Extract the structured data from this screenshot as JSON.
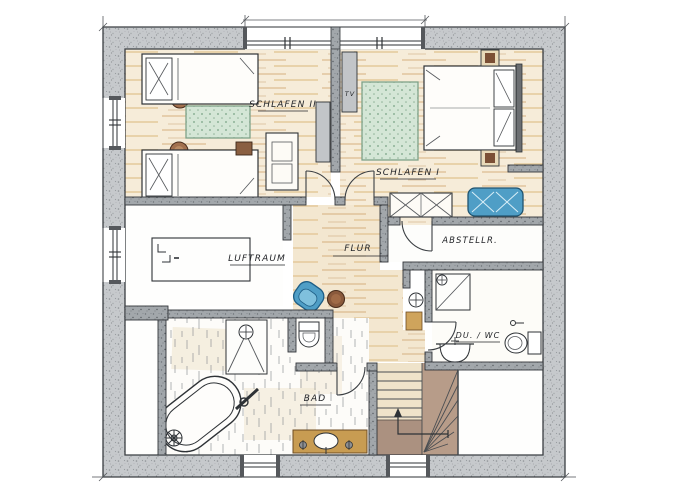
{
  "plan": {
    "type": "floor-plan",
    "style": "hand-drawn-color-pencil"
  },
  "palette": {
    "paper": "#ffffff",
    "wall_exterior": "#c6c9cc",
    "wall_interior": "#a2a7ab",
    "pencil_line": "#3a3e42",
    "wood_floor": "#f6ecd9",
    "wood_stroke": "#c89a5e",
    "rug_green": "#d4e6d6",
    "rug_dot_green": "#6e9a7b",
    "upholstery_blue": "#4f9ec6",
    "table_brown": "#8a5a3c",
    "vanity_wood": "#c89c52",
    "stair_beige": "#efe3ca",
    "stair_brown": "#b79c89",
    "cabinet_gray": "#c2c5c8"
  },
  "rooms": [
    {
      "id": "schlafen-2",
      "label": "SCHLAFEN II",
      "furniture": [
        "single-bed",
        "single-bed",
        "round-stool",
        "round-stool",
        "green-rug",
        "side-table",
        "dresser",
        "sideboard"
      ]
    },
    {
      "id": "schlafen-1",
      "label": "SCHLAFEN I",
      "tv_label": "TV",
      "furniture": [
        "double-bed",
        "nightstand",
        "nightstand",
        "green-rug",
        "tv-lowboard",
        "wardrobe",
        "blue-bench"
      ]
    },
    {
      "id": "abstellraum",
      "label": "ABSTELLR.",
      "furniture": []
    },
    {
      "id": "luftraum",
      "label": "LUFTRAUM",
      "furniture": []
    },
    {
      "id": "flur",
      "label": "FLUR",
      "furniture": [
        "blue-armchair",
        "round-side-table",
        "hand-basin",
        "cabinet"
      ]
    },
    {
      "id": "bad",
      "label": "BAD",
      "furniture": [
        "walk-in-shower",
        "toilet",
        "freestanding-bathtub",
        "vanity-sink",
        "plant"
      ]
    },
    {
      "id": "du-wc",
      "label": "DU. / WC",
      "furniture": [
        "shower",
        "wash-basin",
        "toilet",
        "towel-radiator"
      ]
    },
    {
      "id": "treppenhaus",
      "label": "",
      "furniture": [
        "staircase-up"
      ]
    }
  ]
}
